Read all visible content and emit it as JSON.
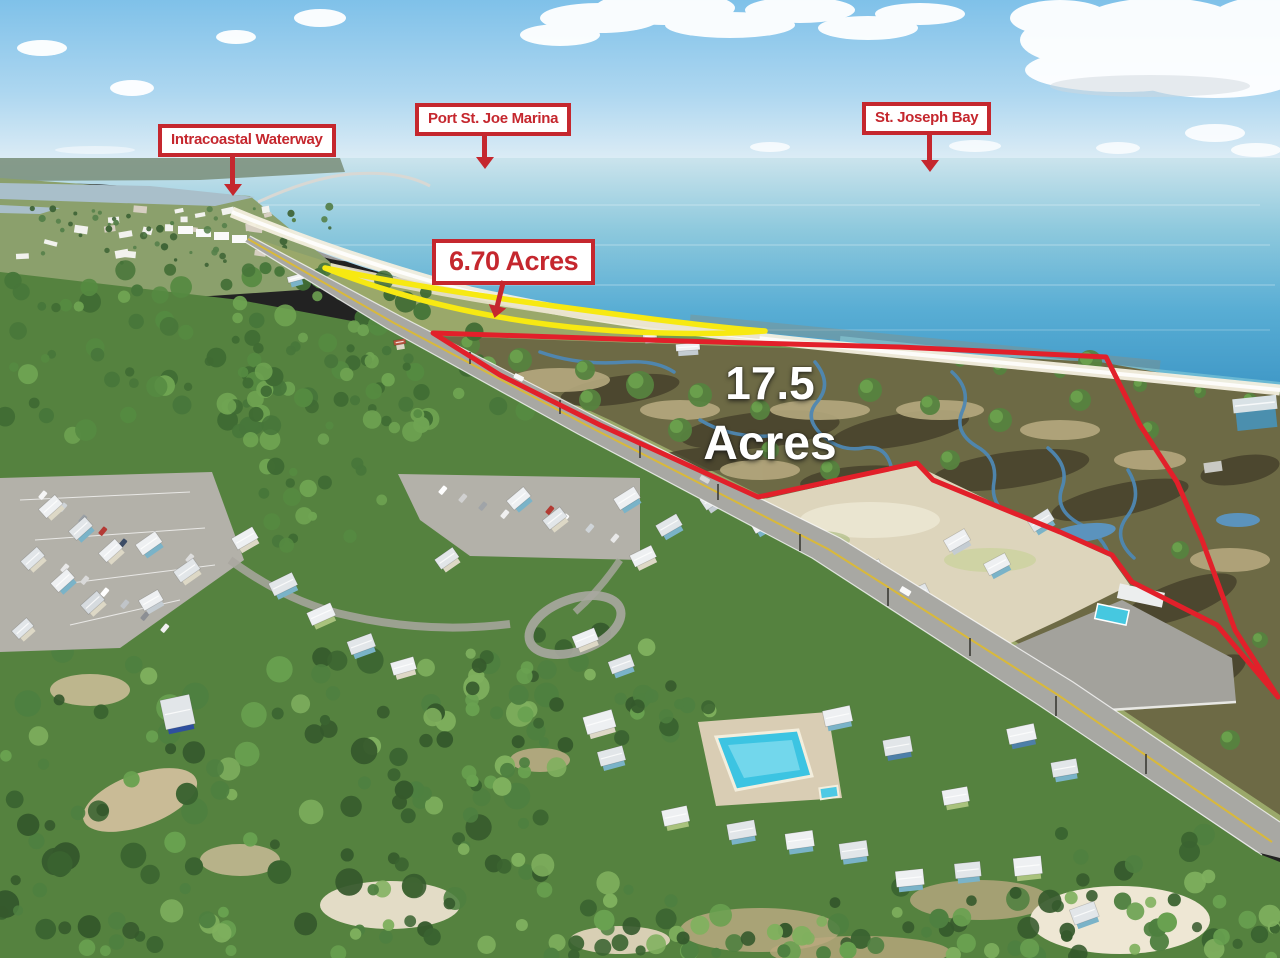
{
  "labels": {
    "intracoastal": "Intracoastal Waterway",
    "marina": "Port St. Joe Marina",
    "bay": "St. Joseph Bay",
    "parcel_small": "6.70 Acres",
    "parcel_large_line1": "17.5",
    "parcel_large_line2": "Acres"
  },
  "colors": {
    "annotation_red": "#c5272e",
    "boundary_red": "#e2202a",
    "parcel_yellow": "#f7e912",
    "overlay_text_white": "#ffffff"
  }
}
